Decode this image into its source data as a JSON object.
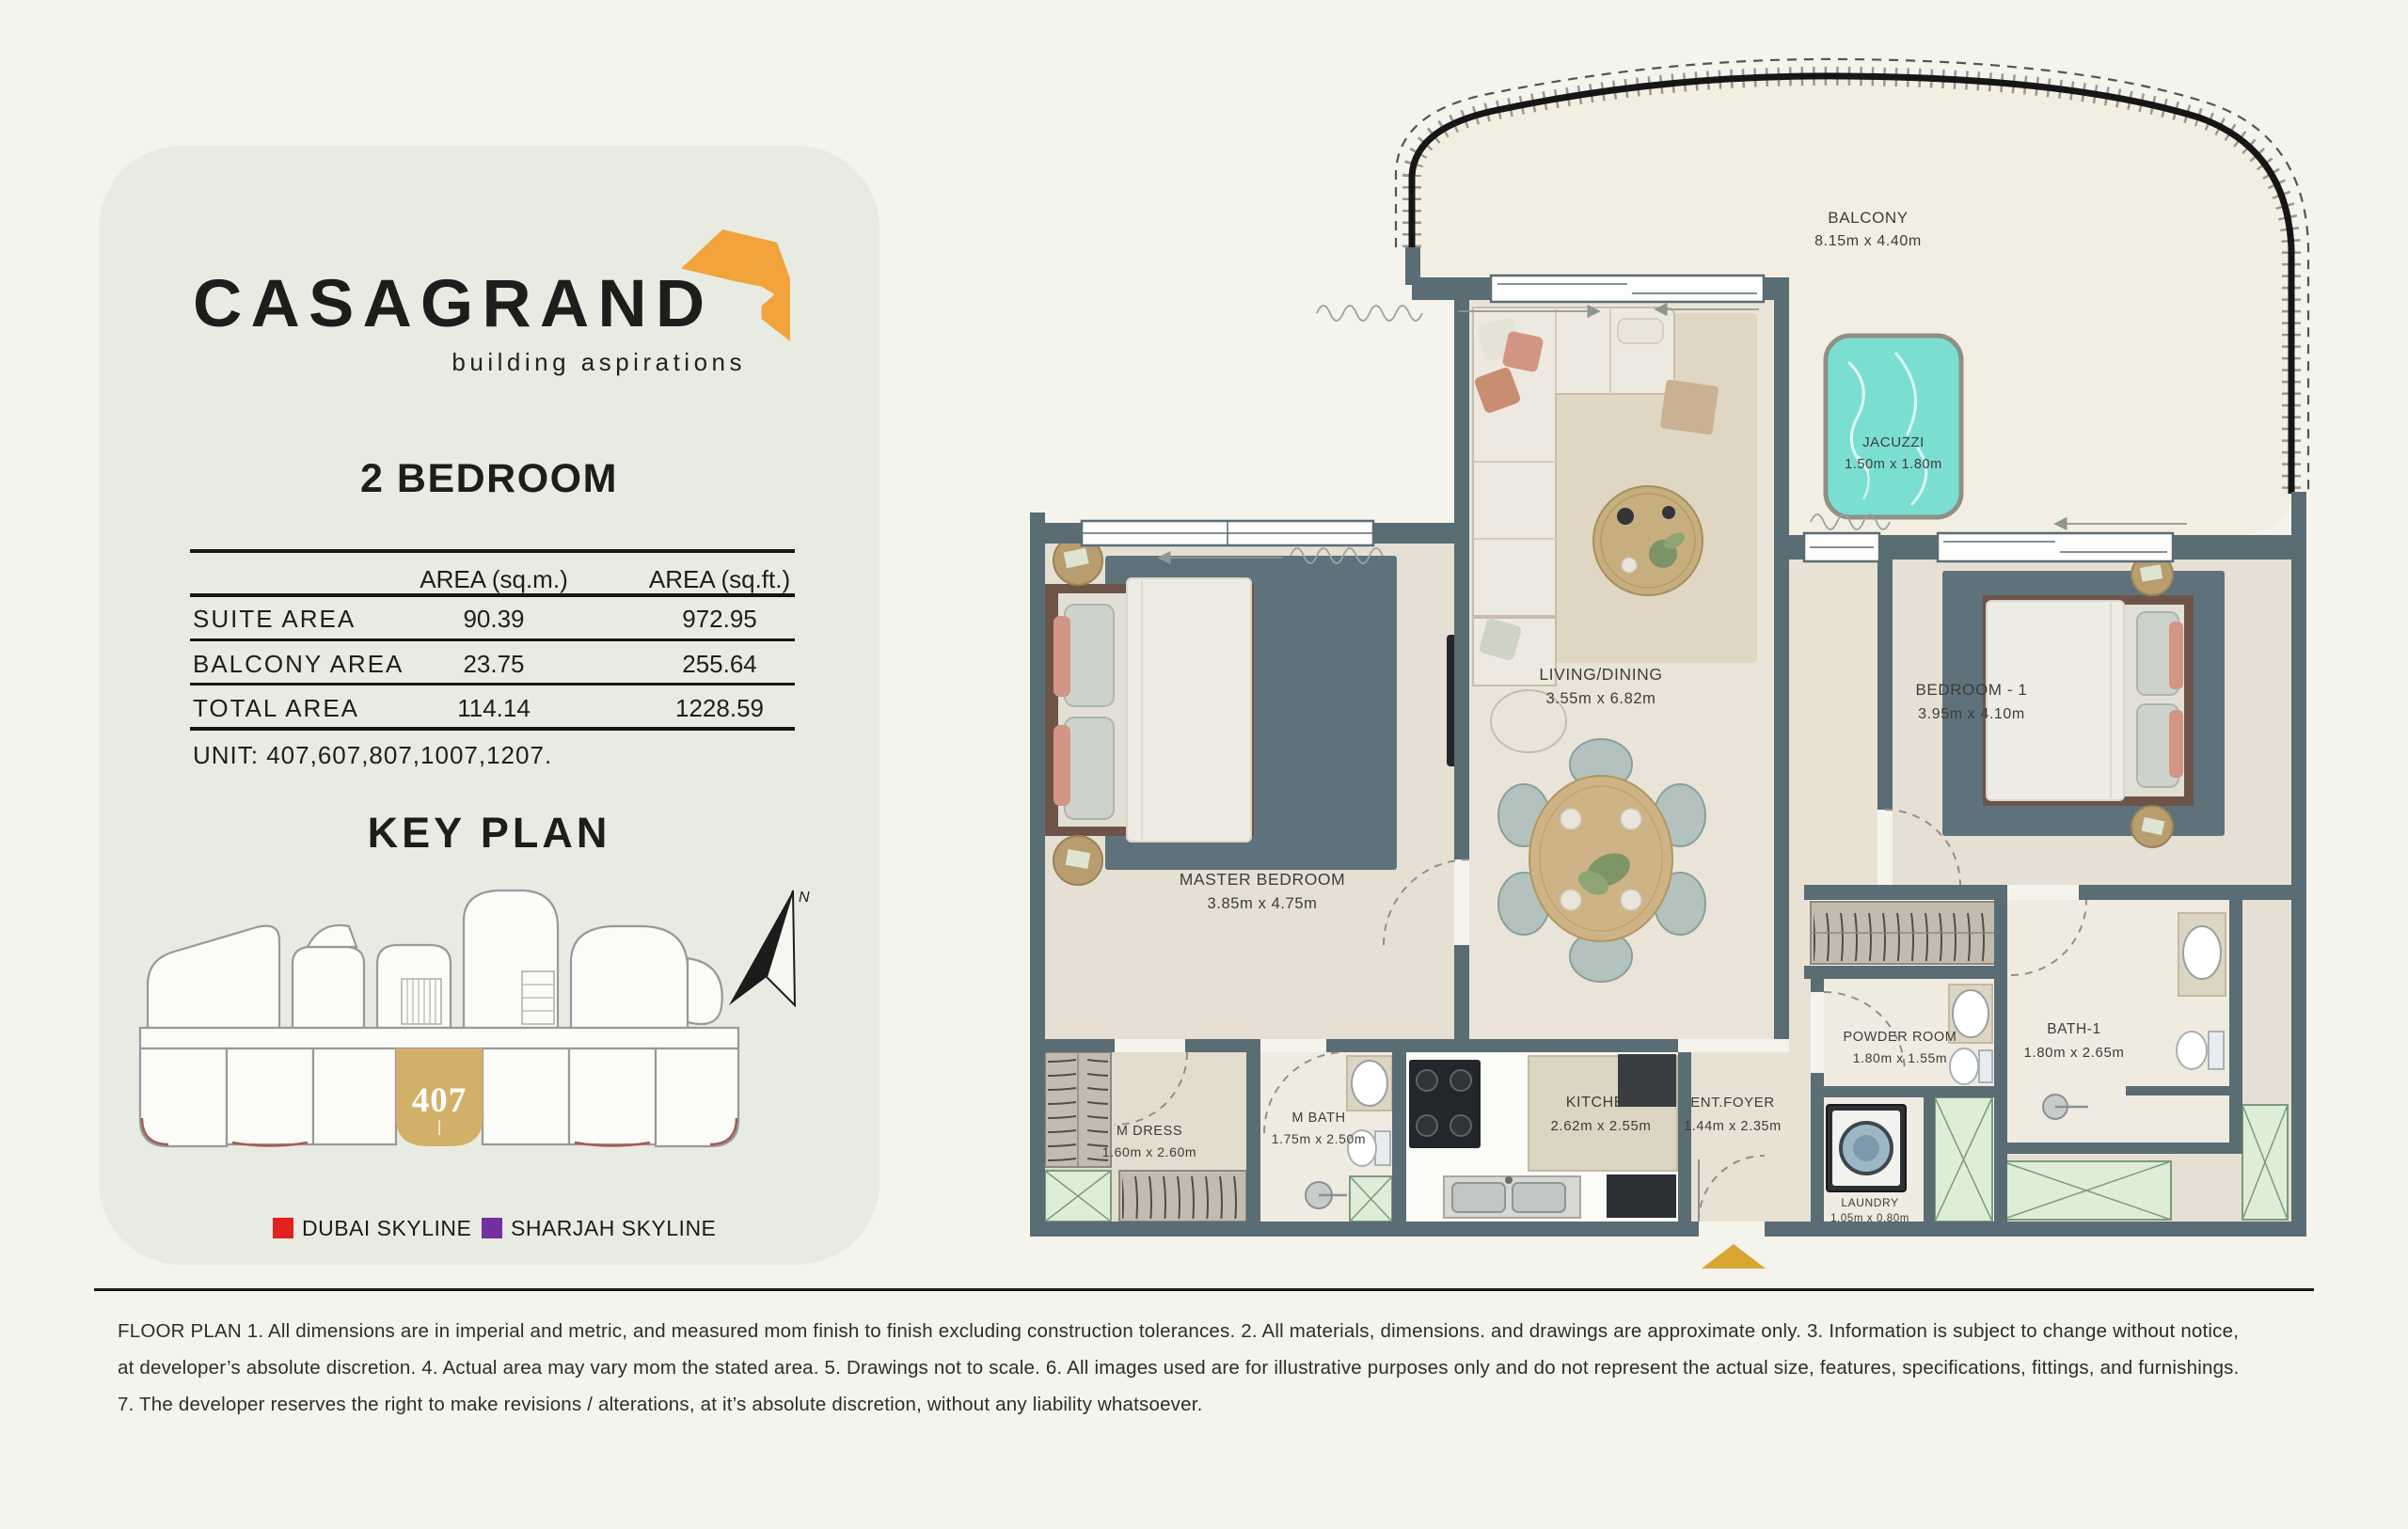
{
  "brand": {
    "name": "CASAGRAND",
    "tagline": "building aspirations",
    "orange": "#F2A33C"
  },
  "unit_card": {
    "title": "2 BEDROOM",
    "table": {
      "col_sqm": "AREA (sq.m.)",
      "col_sqft": "AREA (sq.ft.)",
      "rows": [
        {
          "label": "SUITE  AREA",
          "sqm": "90.39",
          "sqft": "972.95"
        },
        {
          "label": "BALCONY  AREA",
          "sqm": "23.75",
          "sqft": "255.64"
        },
        {
          "label": "TOTAL  AREA",
          "sqm": "114.14",
          "sqft": "1228.59"
        }
      ]
    },
    "unit_line": "UNIT: 407,607,807,1007,1207.",
    "key_plan": {
      "title": "KEY PLAN",
      "unit_number": "407",
      "unit_color": "#D2B06A",
      "north_label": "N",
      "legend": [
        {
          "label": "DUBAI SKYLINE",
          "color": "#E3211F"
        },
        {
          "label": "SHARJAH SKYLINE",
          "color": "#7430A0"
        }
      ]
    }
  },
  "floor_plan": {
    "wall_color": "#5A6C74",
    "jacuzzi_color": "#7ADFD1",
    "entry_marker_color": "#D9A531",
    "rooms": {
      "balcony": {
        "name": "BALCONY",
        "dims": "8.15m x 4.40m"
      },
      "jacuzzi": {
        "name": "JACUZZI",
        "dims": "1.50m x 1.80m"
      },
      "living": {
        "name": "LIVING/DINING",
        "dims": "3.55m x 6.82m"
      },
      "master": {
        "name": "MASTER BEDROOM",
        "dims": "3.85m x 4.75m"
      },
      "bedroom1": {
        "name": "BEDROOM - 1",
        "dims": "3.95m x 4.10m"
      },
      "mdress": {
        "name": "M DRESS",
        "dims": "1.60m x 2.60m"
      },
      "mbath": {
        "name": "M BATH",
        "dims": "1.75m x 2.50m"
      },
      "kitchen": {
        "name": "KITCHEN",
        "dims": "2.62m x 2.55m"
      },
      "foyer": {
        "name": "ENT.FOYER",
        "dims": "1.44m x 2.35m"
      },
      "powder": {
        "name": "POWDER ROOM",
        "dims": "1.80m x 1.55m"
      },
      "laundry": {
        "name": "LAUNDRY",
        "dims": "1.05m x 0.80m"
      },
      "bath1": {
        "name": "BATH-1",
        "dims": "1.80m x 2.65m"
      }
    }
  },
  "footer": {
    "lines": [
      "FLOOR PLAN 1. All dimensions are in imperial and metric, and measured mom finish to finish excluding construction tolerances. 2. All materials, dimensions. and drawings are approximate only. 3. Information is subject to change without notice,",
      "at developer’s absolute discretion. 4. Actual area may vary mom the stated area. 5. Drawings not to scale. 6. All images used are for illustrative purposes only and do not represent the actual size, features, specifications, fittings, and furnishings.",
      "7. The developer reserves the right to make revisions / alterations, at it’s absolute discretion, without any liability whatsoever."
    ]
  }
}
